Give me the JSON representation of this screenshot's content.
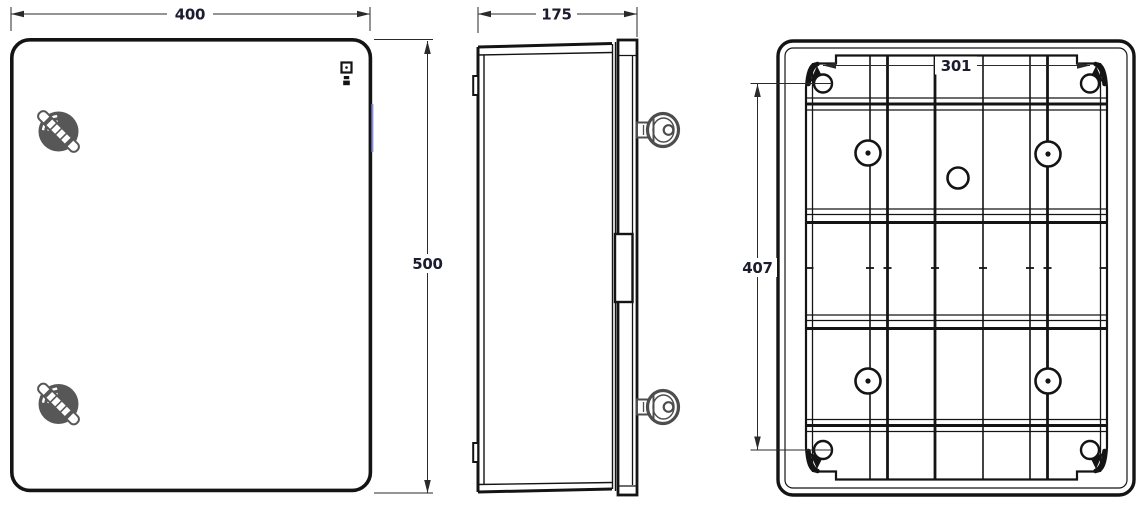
{
  "drawing": {
    "colors": {
      "line": "#141414",
      "dim_line": "#2a2a2a",
      "dim_text": "#1c1c30",
      "latch_gray": "#575757",
      "key_gray": "#4d4d4d",
      "accent_blue": "#8c8cdb",
      "background": "#ffffff"
    },
    "dimensions": {
      "front_width": "400",
      "front_height": "500",
      "side_depth": "175",
      "back_hole_spacing_horizontal": "301",
      "back_hole_spacing_vertical": "407"
    }
  }
}
